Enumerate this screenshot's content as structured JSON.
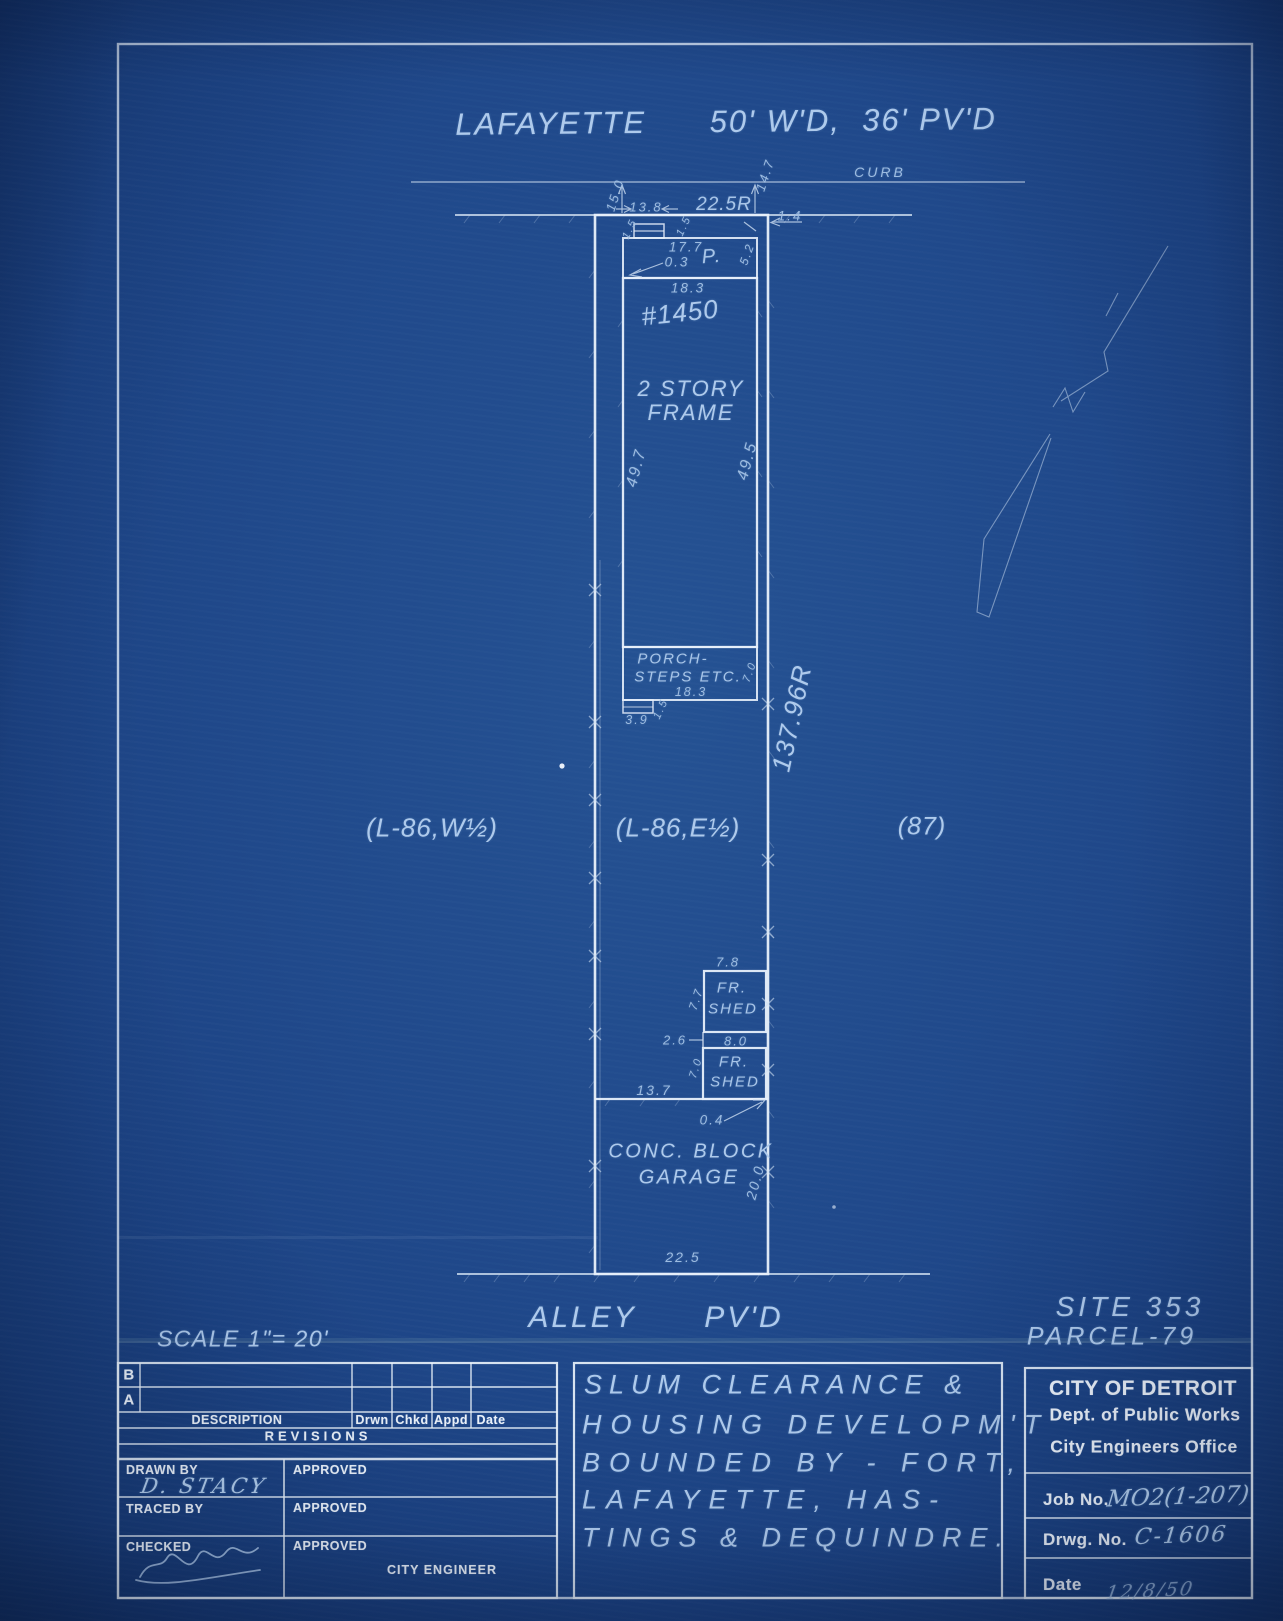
{
  "plan": {
    "street": "LAFAYETTE      50' W'D,  36' PV'D",
    "curb": "CURB",
    "alley": "ALLEY      PV'D",
    "site": "SITE 353",
    "parcel": "PARCEL-79",
    "scale": "SCALE 1\"= 20'",
    "house_number": "#1450",
    "building_line1": "2 STORY",
    "building_line2": "FRAME",
    "porch_label": "P.",
    "porch_steps_line1": "PORCH-",
    "porch_steps_line2": "STEPS ETC.",
    "shed1_line1": "FR.",
    "shed1_line2": "SHED",
    "shed2_line1": "FR.",
    "shed2_line2": "SHED",
    "garage_line1": "CONC. BLOCK",
    "garage_line2": "GARAGE",
    "lot_left": "(L-86,W½)",
    "lot_center": "(L-86,E½)",
    "lot_right": "(87)",
    "lot_depth": "137.96R",
    "dims": {
      "curb_to_lot_w": "15.0",
      "offset_13_8": "13.8",
      "lot_width": "22.5R",
      "curb_to_lot_e": "14.7",
      "offset_1_4": "1.4",
      "stoop_w": "1.5",
      "stoop_d": "1.5",
      "porch_w": "17.7",
      "porch_off": "0.3",
      "porch_d": "5.2",
      "bldg_w": "18.3",
      "bldg_len_w": "49.7",
      "bldg_len_e": "49.5",
      "steps_w": "18.3",
      "steps_d": "7.0",
      "step_w": "3.9",
      "step_d": "1.5",
      "shed1_w": "7.8",
      "shed1_d": "7.7",
      "shed_gap": "2.6",
      "shed2_w": "8.0",
      "shed2_d": "7.0",
      "garage_off": "13.7",
      "garage_corner": "0.4",
      "garage_d": "20.0",
      "garage_w": "22.5"
    }
  },
  "titleblock": {
    "rev_rows": [
      "B",
      "A"
    ],
    "description": "DESCRIPTION",
    "cols": [
      "Drwn",
      "Chkd",
      "Appd",
      "Date"
    ],
    "revisions": "REVISIONS",
    "drawn_by": "DRAWN BY",
    "drawn_by_value": "D. STACY",
    "traced_by": "TRACED BY",
    "checked": "CHECKED",
    "approved": [
      "APPROVED",
      "APPROVED",
      "APPROVED"
    ],
    "city_engineer": "CITY ENGINEER",
    "title_lines": [
      "SLUM CLEARANCE &",
      "HOUSING DEVELOPM'T",
      "BOUNDED BY - FORT,",
      "LAFAYETTE, HAS-",
      "TINGS & DEQUINDRE."
    ],
    "org_line1": "CITY OF DETROIT",
    "org_line2": "Dept. of Public Works",
    "org_line3": "City Engineers Office",
    "job_no_label": "Job No.",
    "job_no_value": "MO2(1-207)",
    "drwg_no_label": "Drwg. No.",
    "drwg_no_value": "C-1606",
    "date_label": "Date",
    "date_value": "12/8/50"
  }
}
